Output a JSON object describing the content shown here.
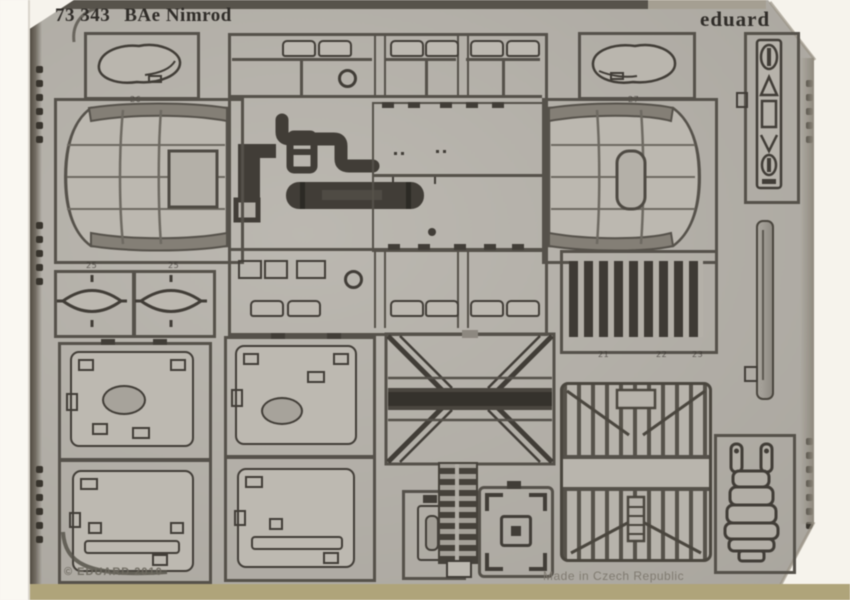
{
  "photo": {
    "header": {
      "catalog_number": "73 343",
      "product_name": "BAe Nimrod",
      "brand": "eduard"
    },
    "footer": {
      "copyright": "© EDUARD 2010",
      "made_in": "Made in Czech Republic"
    },
    "part_labels": {
      "fairing_left": "26",
      "fairing_right": "27",
      "oval_left": "25",
      "oval_right": "25",
      "louver_a": "21",
      "louver_b": "22",
      "louver_c": "23"
    },
    "colors": {
      "background": "#f6f3ec",
      "sheet": "#b4b0a8",
      "sheet_light": "#bdb9b1",
      "etch_line": "#55514a",
      "etch_dark": "#413d37",
      "part_dark": "#413d37",
      "top_band": "#57534b",
      "edge_shadow": "#46413a",
      "bottom_strip": "#b0a478",
      "text_dark": "#302d29"
    }
  }
}
